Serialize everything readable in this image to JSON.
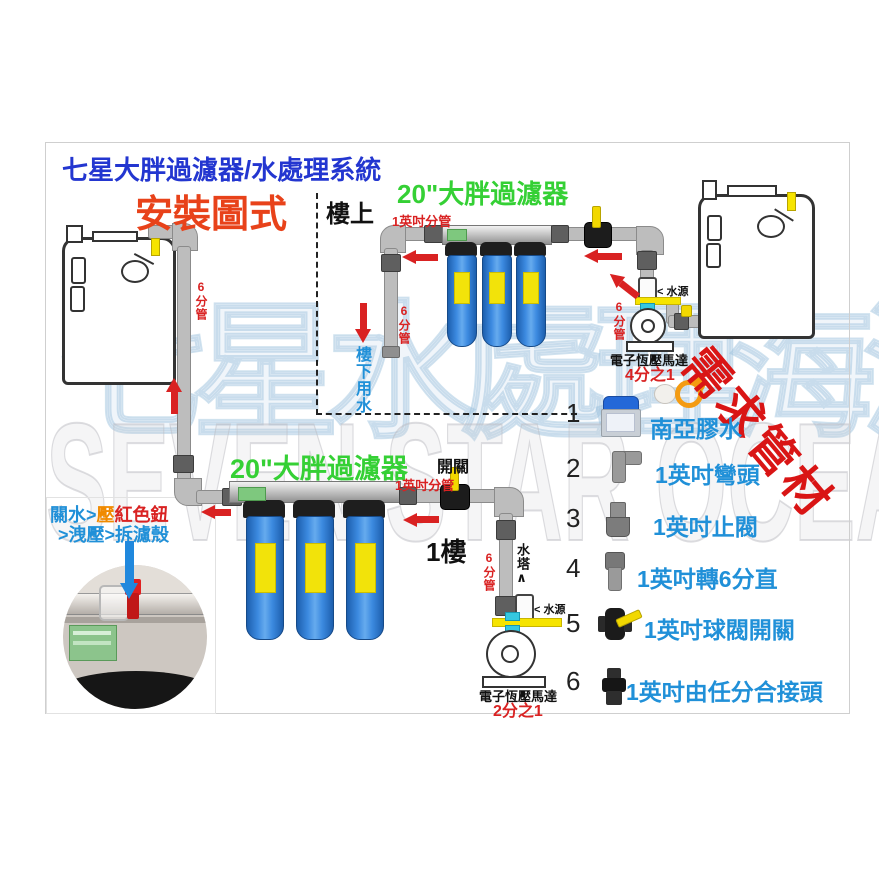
{
  "colors": {
    "title_blue": "#2336d0",
    "subtitle_red": "#e8421a",
    "filter_green": "#35d035",
    "annotation_red": "#d92222",
    "label_blue": "#2090d8",
    "housing_blue": "#3c8ae0",
    "pipe_yellow": "#f6e400"
  },
  "header": {
    "main_title": "七星大胖過濾器/水處理系統",
    "sub_title": "安裝圖式"
  },
  "watermark": {
    "cjk": "七星水處理海洋",
    "latin": "SEVEN STAR OCEAN"
  },
  "upstairs": {
    "zone_label": "樓上",
    "filter_title": "20\"大胖過濾器",
    "branch_pipe_label": "1英吋分管",
    "left_pipe_label": "6分管",
    "right_pipe_label": "6分管",
    "downstairs_water_label": "樓下用水",
    "water_source_label": "< 水源",
    "pump_label": "電子恆壓馬達",
    "pump_spec": "4分之1"
  },
  "left_riser": {
    "pipe_label": "6分管"
  },
  "ground": {
    "floor_label": "1樓",
    "filter_title": "20\"大胖過濾器",
    "branch_pipe_label": "1英吋分管",
    "switch_label": "開關",
    "riser_pipe_label": "6分管",
    "to_tank_label": "水塔",
    "to_tank_arrow": "∧",
    "water_source_label": "< 水源",
    "pump_label": "電子恆壓馬達",
    "pump_spec": "2分之1"
  },
  "instructions": {
    "seg1": "關水>",
    "seg2": "壓",
    "seg3": "紅色鈕",
    "line2": ">洩壓>拆濾殼"
  },
  "parts": {
    "heading": "需求管材",
    "items": [
      {
        "num": "1",
        "name": "南亞膠水",
        "icon": "glue-can-icon"
      },
      {
        "num": "2",
        "name": "1英吋彎頭",
        "icon": "elbow-fitting-icon"
      },
      {
        "num": "3",
        "name": "1英吋止閥",
        "icon": "check-valve-icon"
      },
      {
        "num": "4",
        "name": "1英吋轉6分直",
        "icon": "reducer-icon"
      },
      {
        "num": "5",
        "name": "1英吋球閥開關",
        "icon": "ball-valve-icon"
      },
      {
        "num": "6",
        "name": "1英吋由任分合接頭",
        "icon": "union-fitting-icon"
      }
    ]
  }
}
